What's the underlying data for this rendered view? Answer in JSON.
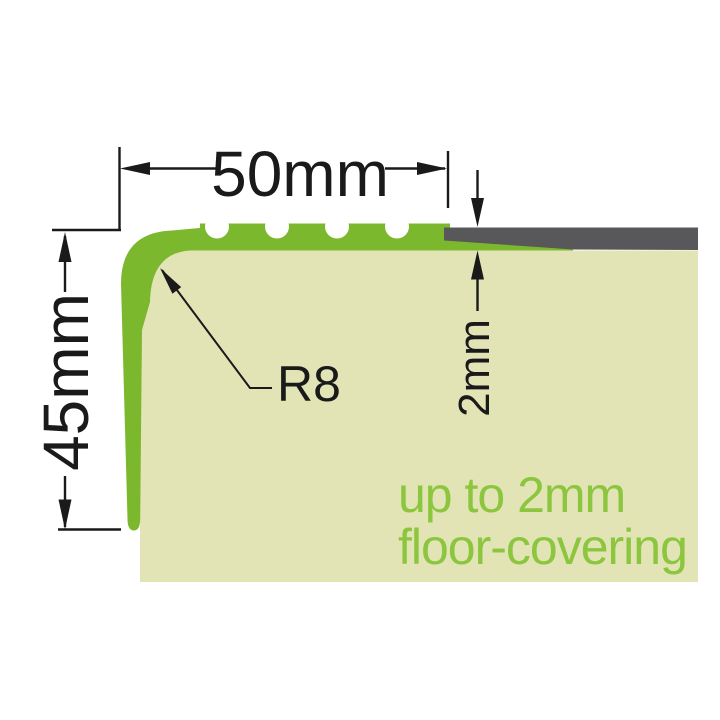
{
  "diagram": {
    "width_dimension": "50mm",
    "height_dimension": "45mm",
    "radius_callout": "R8",
    "thickness_dimension": "2mm",
    "note_line1": "up to 2mm",
    "note_line2": "floor-covering"
  },
  "colors": {
    "profile_green": "#7CB82E",
    "substrate_beige": "#E3E4B6",
    "covering_gray": "#58585A",
    "dimension_ink": "#1A1A1A",
    "note_green": "#8CC63F",
    "background": "#FFFFFF"
  }
}
